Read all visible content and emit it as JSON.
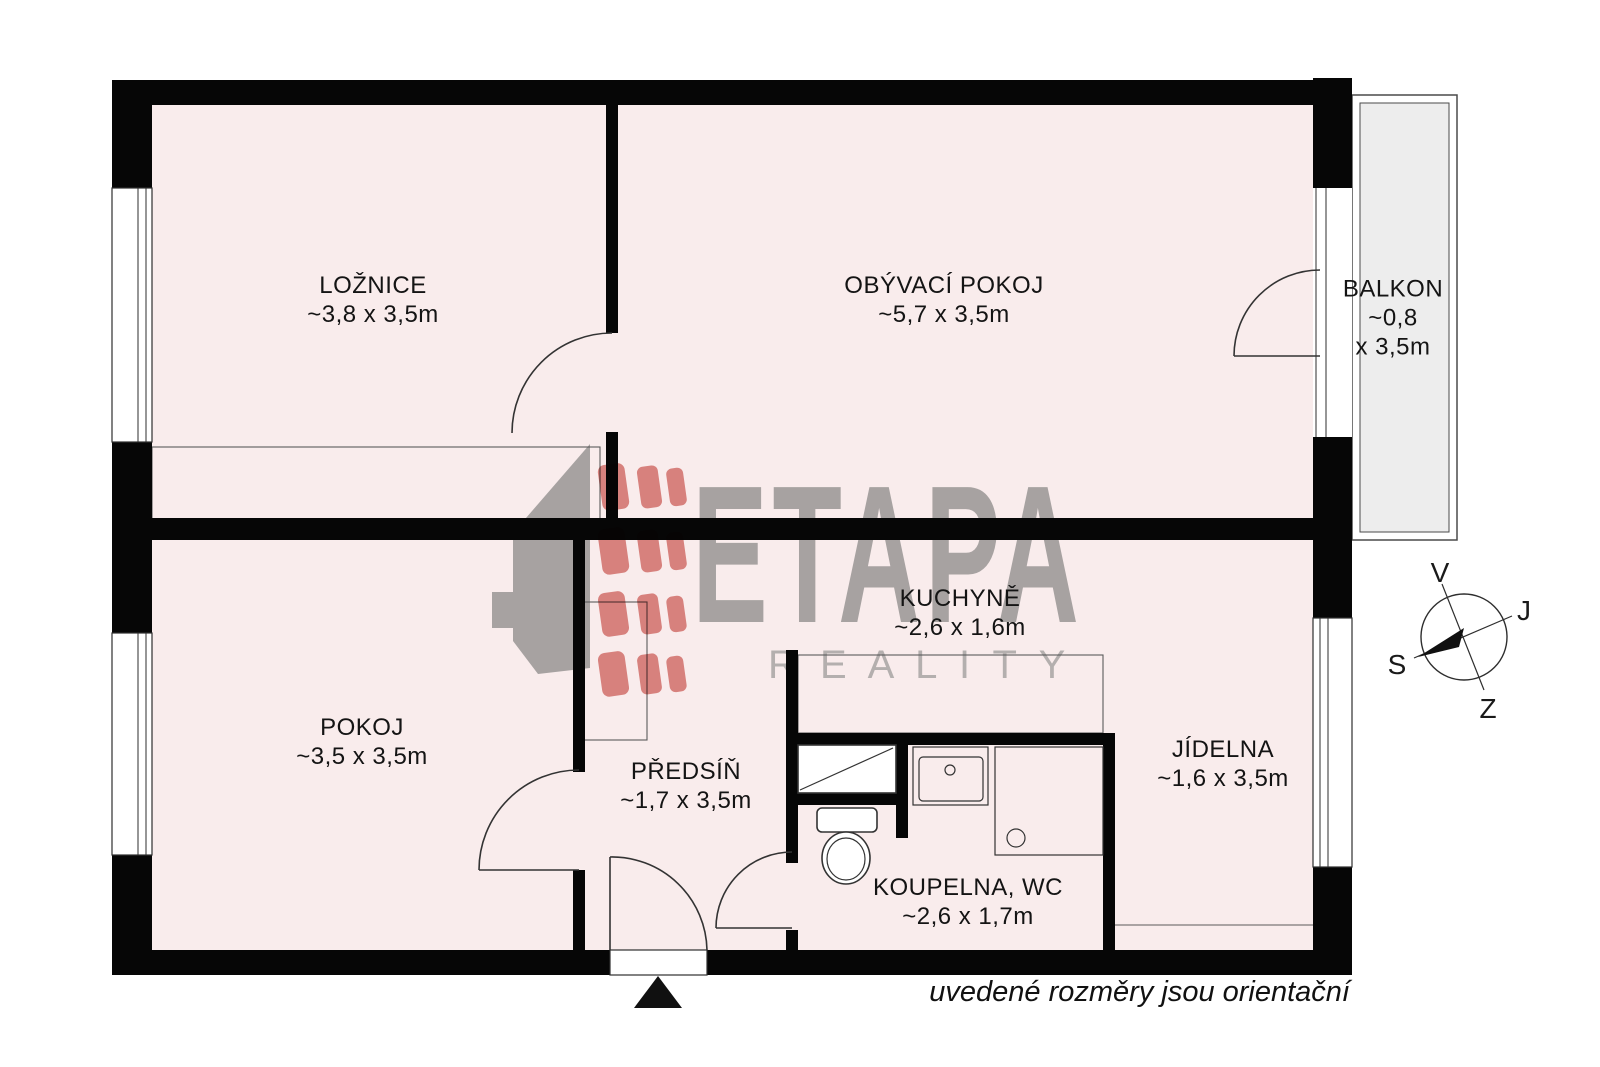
{
  "rooms": {
    "loznice": {
      "name": "LOŽNICE",
      "dims": "~3,8 x 3,5m"
    },
    "obyvaci_pokoj": {
      "name": "OBÝVACÍ POKOJ",
      "dims": "~5,7 x 3,5m"
    },
    "balkon": {
      "name": "BALKON",
      "dims_line1": "~0,8",
      "dims_line2": "x 3,5m"
    },
    "kuchyne": {
      "name": "KUCHYNĚ",
      "dims": "~2,6 x 1,6m"
    },
    "pokoj": {
      "name": "POKOJ",
      "dims": "~3,5 x 3,5m"
    },
    "predsin": {
      "name": "PŘEDSÍŇ",
      "dims": "~1,7 x 3,5m"
    },
    "jidelna": {
      "name": "JÍDELNA",
      "dims": "~1,6 x 3,5m"
    },
    "koupelna": {
      "name": "KOUPELNA, WC",
      "dims": "~2,6 x 1,7m"
    }
  },
  "branding": {
    "name": "ETAPA",
    "tagline": "R E A L I T Y"
  },
  "compass": {
    "top": "V",
    "right": "J",
    "left": "S",
    "bottom": "Z"
  },
  "footer": {
    "note": "uvedené rozměry jsou orientační"
  },
  "colors": {
    "room_fill": "#f9ecec",
    "balcony_fill": "#ededed",
    "wall": "#060606",
    "logo_gray": "#a7a2a1",
    "logo_red": "#dd8b87"
  }
}
